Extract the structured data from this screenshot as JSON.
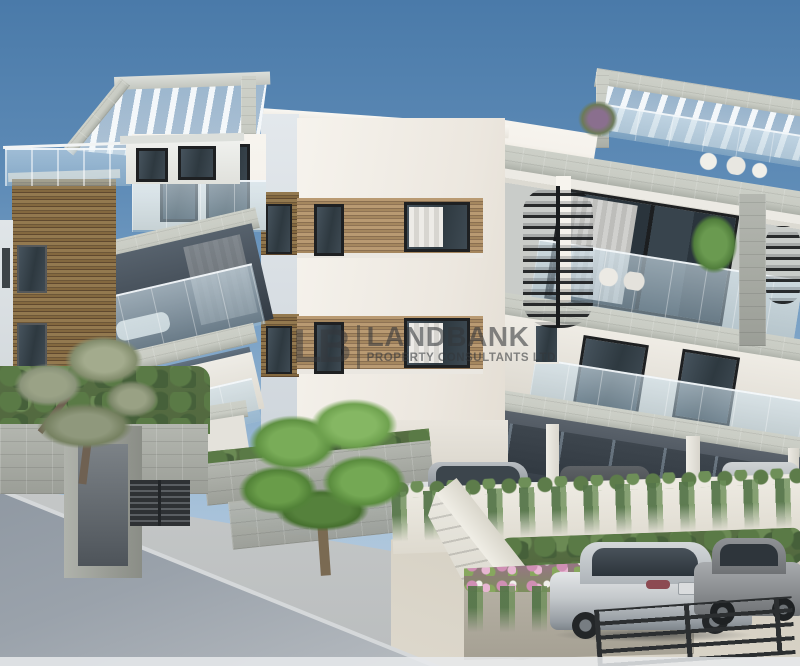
{
  "watermark": {
    "logo": "LB",
    "name": "LANDBANK",
    "tagline": "PROPERTY CONSULTANTS LTD"
  },
  "palette": {
    "sky_top": "#4a7aa9",
    "sky_mid": "#7fa5c8",
    "sky_low": "#c6d6e4",
    "wall_light": "#f5f2ec",
    "wall_shade": "#cfd6dc",
    "wood_light": "#b99a72",
    "wood_dark": "#8a6f50",
    "slab": "#c9ccc4",
    "slab_dark": "#a9ada5",
    "soffit": "#414a53",
    "glass_dark": "#2e3940",
    "frame": "#1e2022",
    "road": "#9aa2ab",
    "pavement": "#cfc9bc",
    "foliage_olive": "#8b947a",
    "foliage_green": "#6fa24f",
    "hedge": "#52683f",
    "vine": "#5d7c4a",
    "flower": "#cf8fb4",
    "car_silver": "#c4c8cb",
    "car_dark": "#8d9093",
    "rail_metal": "#2c2f31",
    "watermark_gray": "#3a3d40"
  }
}
